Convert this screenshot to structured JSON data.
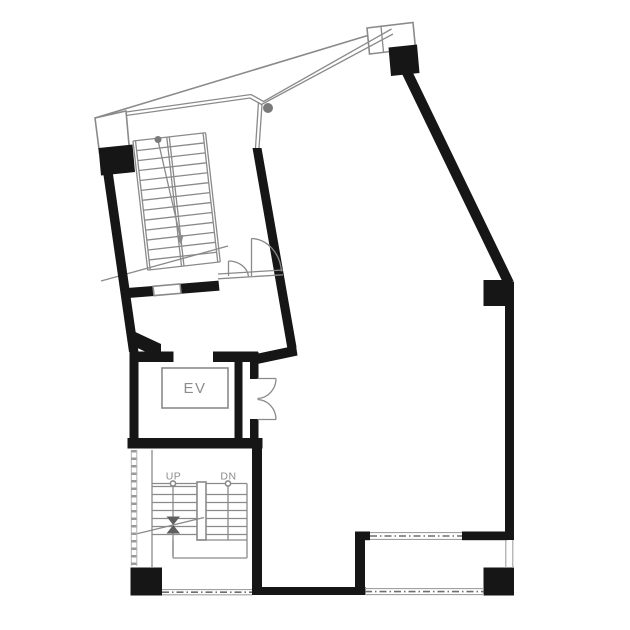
{
  "labels": {
    "elevator": "EV",
    "stairs_up": "UP",
    "stairs_down": "DN"
  },
  "colors": {
    "background": "#ffffff",
    "wall": "#161616",
    "thin_line": "#8a8a8a",
    "dash_line": "#6e6e6e",
    "dot": "#7a7a7a",
    "label_text": "#8c8c8c",
    "hatch": "#9a9a9a"
  }
}
